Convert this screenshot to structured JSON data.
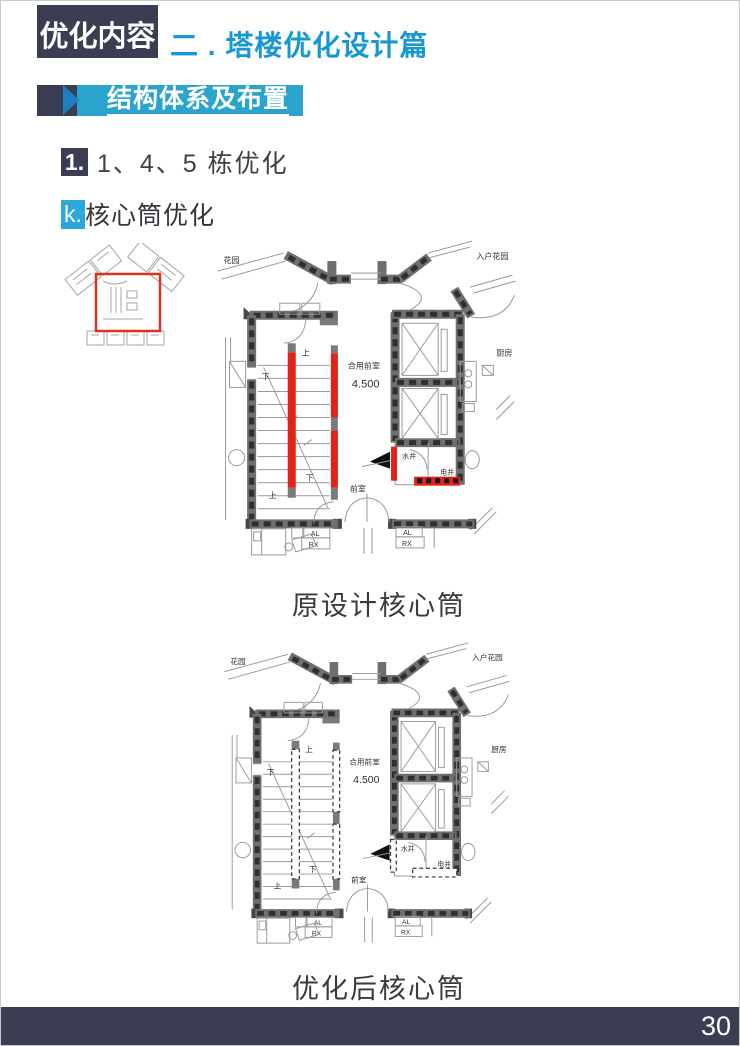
{
  "header": {
    "kicker": "优化内容",
    "title": "二 . 塔楼优化设计篇",
    "section_banner": "结构体系及布置"
  },
  "headings": {
    "item_number": "1.",
    "item_title": "1、4、5 栋优化",
    "sub_letter": "k.",
    "sub_title": "核心筒优化"
  },
  "figures": {
    "original_caption": "原设计核心筒",
    "optimized_caption": "优化后核心筒"
  },
  "plan_labels": {
    "garden": "花园",
    "entry_garden": "入户花园",
    "shared_lobby": "合用前室",
    "level": "4.500",
    "lobby": "前室",
    "kitchen": "厨房",
    "water_shaft": "水井",
    "electric_shaft": "电井",
    "down": "下",
    "up": "上",
    "al": "AL",
    "rx": "RX"
  },
  "footer": {
    "page_number": "30"
  },
  "colors": {
    "navy": "#3b3e52",
    "title_blue": "#1798d5",
    "banner_teal": "#2aa4cd",
    "banner_arrow": "#1d80c2",
    "k_box_blue": "#2ba7dc",
    "highlight_red": "#e3231a",
    "wall_gray": "#6f6f6f"
  }
}
